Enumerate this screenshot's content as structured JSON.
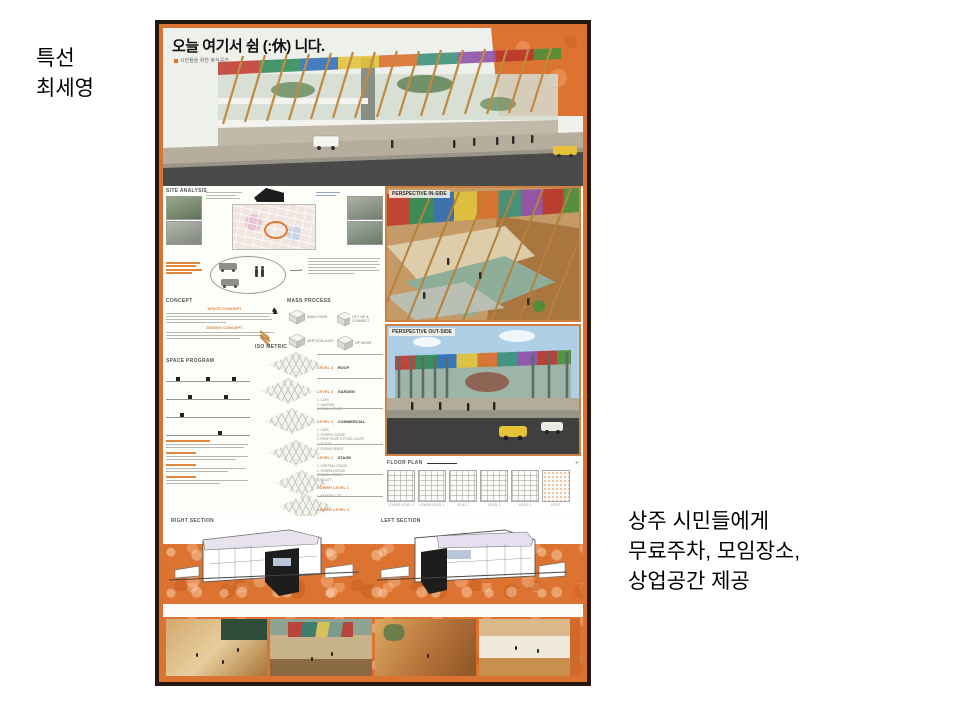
{
  "slide": {
    "author_label": {
      "line1": "특선",
      "line2": "최세영"
    },
    "note": {
      "line1": "상주 시민들에게",
      "line2": "무료주차, 모임장소,",
      "line3": "상업공간 제공"
    }
  },
  "poster": {
    "title": "오늘 여기서 쉼 (:休) 니다.",
    "subtitle": "시민들을 위한 휴식공간",
    "headers": {
      "site_analysis": "SITE ANALYSIS",
      "concept": "CONCEPT",
      "space_concept": "SPACE CONCEPT",
      "design_concept": "DESIGN CONCEPT",
      "mass_process": "MASS PROCESS",
      "iso_metric": "ISO METRIC",
      "space_program": "SPACE PROGRAM",
      "floor_plan": "FLOOR PLAN",
      "right_section": "RIGHT SECTION",
      "left_section": "LEFT SECTION",
      "perspective_inside": "PERSPECTIVE IN-SIDE",
      "perspective_outside": "PERSPECTIVE OUT-SIDE"
    },
    "mass_steps": [
      "MAIN CORE",
      "VERTICAL AXIS",
      "LIFT UP & CONNECT",
      "UP MOVE"
    ],
    "iso_levels": [
      {
        "level": "LEVEL 4",
        "name": "ROOF",
        "items": ""
      },
      {
        "level": "LEVEL 3",
        "name": "GARDEN",
        "items": "1. CAFE\n2. GARDEN\n3. SMALL STAGE"
      },
      {
        "level": "LEVEL 2",
        "name": "COMMERCIAL",
        "items": "1. CAFE\n2. SCREEN STAGE\n3. PROP SHOP & FOOD COURT\n4. TOILET\n5. EATING SPACE"
      },
      {
        "level": "LEVEL 1",
        "name": "STAGE",
        "items": "1. CENTRAL STAGE\n2. SCREEN STAGE\n3. SMALL STAGE\n4. TOILET"
      },
      {
        "level": "LOWER LEVEL 1",
        "name": "",
        "items": "1. PARKING LOT"
      },
      {
        "level": "LOWER LEVEL 2",
        "name": "",
        "items": "1. PARKING LOT"
      }
    ],
    "floor_plans": [
      "LOWER LEVEL 2",
      "LOWER LEVEL 1",
      "LEVEL 1",
      "LEVEL 2",
      "LEVEL 3",
      "ROOF"
    ],
    "floor_plan_plus": "+",
    "bottom_captions": [
      {
        "level": "LEVEL 1 - 2",
        "name": "SCREEN STAGE"
      },
      {
        "level": "LEVEL 2 - 3",
        "name": "SMALL STAGE"
      },
      {
        "level": "LEVEL 2 - 3",
        "name": "CAFE"
      },
      {
        "level": "LEVEL 2 - 3",
        "name": "PROP SHOP & FOOD COURT"
      }
    ],
    "colors": {
      "accent_orange": "#dd7331",
      "wood": "#c08a42",
      "frame_dark": "#241711"
    }
  }
}
